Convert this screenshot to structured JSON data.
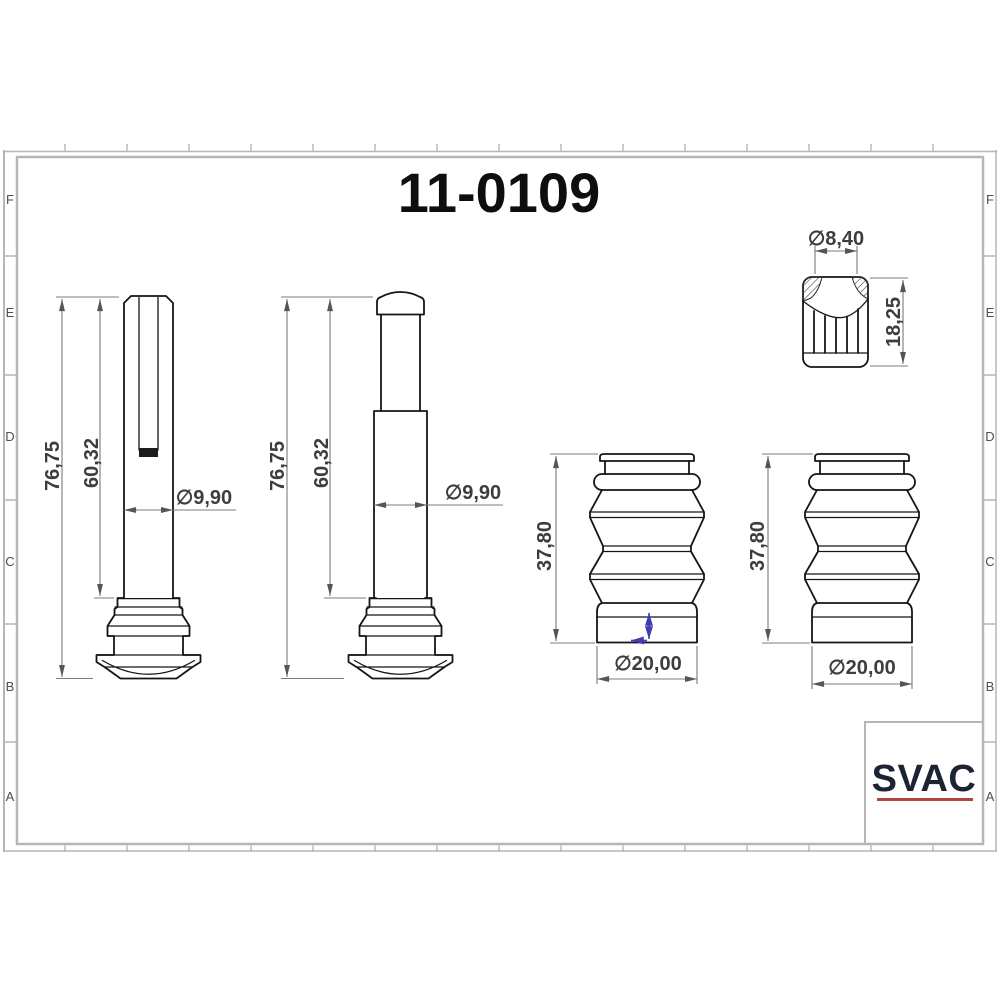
{
  "sheet": {
    "title": "11-0109",
    "row_labels": [
      "F",
      "E",
      "D",
      "C",
      "B",
      "A"
    ]
  },
  "title_block": {
    "logo_text": "SVAC"
  },
  "views": {
    "pin_slotted": {
      "dim_overall": "76,75",
      "dim_shaft": "60,32",
      "dim_diameter": "∅9,90"
    },
    "pin_capped": {
      "dim_overall": "76,75",
      "dim_shaft": "60,32",
      "dim_diameter": "∅9,90"
    },
    "boot_left": {
      "dim_height": "37,80",
      "dim_diameter": "∅20,00"
    },
    "boot_right": {
      "dim_height": "37,80",
      "dim_diameter": "∅20,00"
    },
    "bushing": {
      "dim_diameter": "∅8,40",
      "dim_height": "18,25"
    }
  },
  "colors": {
    "part_line": "#151515",
    "dim_line": "#7b7b7b",
    "dim_text": "#3d3d3d",
    "frame": "#b6b6b6",
    "blue_annotation": "#3e3db2",
    "logo_navy": "#1c2433",
    "logo_red": "#b5453e"
  }
}
